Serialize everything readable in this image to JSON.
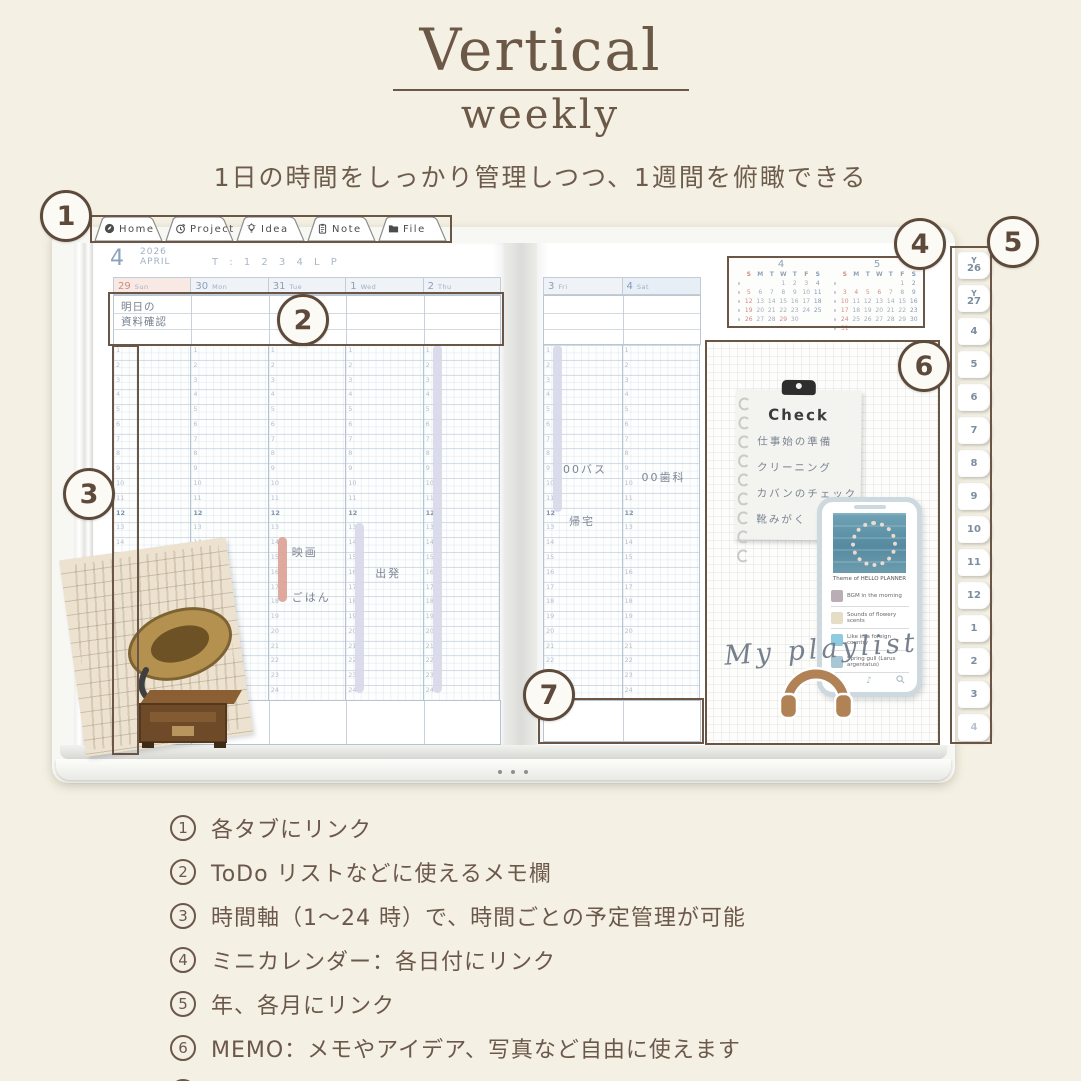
{
  "title": {
    "main": "Vertical",
    "sub": "weekly"
  },
  "subtitle": "1日の時間をしっかり管理しつつ、1週間を俯瞰できる",
  "colors": {
    "background": "#f4f0e3",
    "accent_brown": "#6b5847",
    "annotation": "#6a5647",
    "highlight_pink": "#dda094",
    "highlight_lavender": "#d7d8e9",
    "calendar_red": "#d08b84",
    "calendar_blue": "#7f9ab8",
    "header_blue": "#8ba3bd"
  },
  "top_tabs": [
    {
      "label": "Home",
      "icon": "home-icon"
    },
    {
      "label": "Project",
      "icon": "clock-icon"
    },
    {
      "label": "Idea",
      "icon": "bulb-icon"
    },
    {
      "label": "Note",
      "icon": "clipboard-icon"
    },
    {
      "label": "File",
      "icon": "folder-icon"
    }
  ],
  "left_page": {
    "month_number": "4",
    "year": "2026",
    "month_name": "APRIL",
    "template_row": "T : 1 2 3 4 L P",
    "days": [
      {
        "date": "29",
        "weekday": "Sun",
        "kind": "sun"
      },
      {
        "date": "30",
        "weekday": "Mon",
        "kind": ""
      },
      {
        "date": "31",
        "weekday": "Tue",
        "kind": ""
      },
      {
        "date": "1",
        "weekday": "Wed",
        "kind": ""
      },
      {
        "date": "2",
        "weekday": "Thu",
        "kind": ""
      }
    ],
    "memo_note_lines": [
      "明日の",
      "資料確認"
    ],
    "hour_start": 1,
    "hour_end": 24,
    "events": [
      {
        "day": 2,
        "from": 14,
        "to": 18.4,
        "kind": "bar",
        "color": "pink"
      },
      {
        "day": 2,
        "at": 14.8,
        "label": "映画",
        "dx": 24
      },
      {
        "day": 2,
        "at": 17.8,
        "label": "ごはん",
        "dx": 24
      },
      {
        "day": 3,
        "from": 13,
        "to": 24.5,
        "kind": "bar",
        "color": "lavender"
      },
      {
        "day": 3,
        "at": 16.2,
        "label": "出発",
        "dx": 30
      },
      {
        "day": 4,
        "from": 1,
        "to": 24.5,
        "kind": "bar",
        "color": "lavender"
      }
    ]
  },
  "right_page": {
    "days": [
      {
        "date": "3",
        "weekday": "Fri",
        "kind": ""
      },
      {
        "date": "4",
        "weekday": "Sat",
        "kind": "sat"
      }
    ],
    "hour_start": 1,
    "hour_end": 24,
    "events": [
      {
        "day": 0,
        "from": 1,
        "to": 12.3,
        "kind": "bar",
        "color": "lavender"
      },
      {
        "day": 0,
        "at": 9.2,
        "label": "00バス",
        "dx": 20
      },
      {
        "day": 0,
        "at": 12.7,
        "label": "帰宅",
        "dx": 26
      },
      {
        "day": 1,
        "at": 9.7,
        "label": "00歯科",
        "dx": 20
      }
    ]
  },
  "mini_calendars": [
    {
      "month": "4",
      "weekdays": [
        "S",
        "M",
        "T",
        "W",
        "T",
        "F",
        "S"
      ],
      "weeks": [
        [
          "",
          "",
          "",
          "1",
          "2",
          "3",
          "4"
        ],
        [
          "5",
          "6",
          "7",
          "8",
          "9",
          "10",
          "11"
        ],
        [
          "12",
          "13",
          "14",
          "15",
          "16",
          "17",
          "18"
        ],
        [
          "19",
          "20",
          "21",
          "22",
          "23",
          "24",
          "25"
        ],
        [
          "26",
          "27",
          "28",
          "29",
          "30",
          "",
          ""
        ]
      ],
      "red_dates": [
        "5",
        "12",
        "19",
        "26",
        "29"
      ],
      "blue_dates": [
        "4",
        "11",
        "18",
        "25"
      ]
    },
    {
      "month": "5",
      "weekdays": [
        "S",
        "M",
        "T",
        "W",
        "T",
        "F",
        "S"
      ],
      "weeks": [
        [
          "",
          "",
          "",
          "",
          "",
          "1",
          "2"
        ],
        [
          "3",
          "4",
          "5",
          "6",
          "7",
          "8",
          "9"
        ],
        [
          "10",
          "11",
          "12",
          "13",
          "14",
          "15",
          "16"
        ],
        [
          "17",
          "18",
          "19",
          "20",
          "21",
          "22",
          "23"
        ],
        [
          "24",
          "25",
          "26",
          "27",
          "28",
          "29",
          "30"
        ],
        [
          "31",
          "",
          "",
          "",
          "",
          "",
          ""
        ]
      ],
      "red_dates": [
        "3",
        "4",
        "5",
        "6",
        "10",
        "17",
        "24",
        "31"
      ],
      "blue_dates": [
        "2",
        "9",
        "16",
        "23",
        "30"
      ]
    }
  ],
  "check_note": {
    "title": "Check",
    "items": [
      "仕事始の準備",
      "クリーニング",
      "カバンのチェック",
      "靴みがく"
    ]
  },
  "phone": {
    "caption": "Theme of HELLO PLANNER",
    "tracks": [
      {
        "label": "BGM in the morning",
        "thumb": "#b9aeb6"
      },
      {
        "label": "Sounds of flowery scents",
        "thumb": "#e6ddc6"
      },
      {
        "label": "Like in a foreign country",
        "thumb": "#8fcbe0"
      },
      {
        "label": "Spring gull (Larus argentatus)",
        "thumb": "#a9c6d4"
      }
    ]
  },
  "playlist_label": "My playlist",
  "side_tabs": [
    {
      "prefix": "Y",
      "label": "26",
      "muted": false
    },
    {
      "prefix": "Y",
      "label": "27",
      "muted": false
    },
    {
      "prefix": "",
      "label": "4",
      "muted": false
    },
    {
      "prefix": "",
      "label": "5",
      "muted": false
    },
    {
      "prefix": "",
      "label": "6",
      "muted": false
    },
    {
      "prefix": "",
      "label": "7",
      "muted": false
    },
    {
      "prefix": "",
      "label": "8",
      "muted": false
    },
    {
      "prefix": "",
      "label": "9",
      "muted": false
    },
    {
      "prefix": "",
      "label": "10",
      "muted": false
    },
    {
      "prefix": "",
      "label": "11",
      "muted": false
    },
    {
      "prefix": "",
      "label": "12",
      "muted": false
    },
    {
      "prefix": "",
      "label": "1",
      "muted": false
    },
    {
      "prefix": "",
      "label": "2",
      "muted": false
    },
    {
      "prefix": "",
      "label": "3",
      "muted": false
    },
    {
      "prefix": "",
      "label": "4",
      "muted": true
    }
  ],
  "callouts": [
    "1",
    "2",
    "3",
    "4",
    "5",
    "6",
    "7"
  ],
  "features": [
    {
      "num": "1",
      "text": "各タブにリンク"
    },
    {
      "num": "2",
      "text": "ToDo リストなどに使えるメモ欄"
    },
    {
      "num": "3",
      "text": "時間軸（1〜24 時）で、時間ごとの予定管理が可能"
    },
    {
      "num": "4",
      "text": "ミニカレンダー：各日付にリンク"
    },
    {
      "num": "5",
      "text": "年、各月にリンク"
    },
    {
      "num": "6",
      "text": "MEMO：メモやアイデア、写真など自由に使えます"
    },
    {
      "num": "7",
      "text": "一日の感想や、明日へのメモなどに"
    }
  ]
}
